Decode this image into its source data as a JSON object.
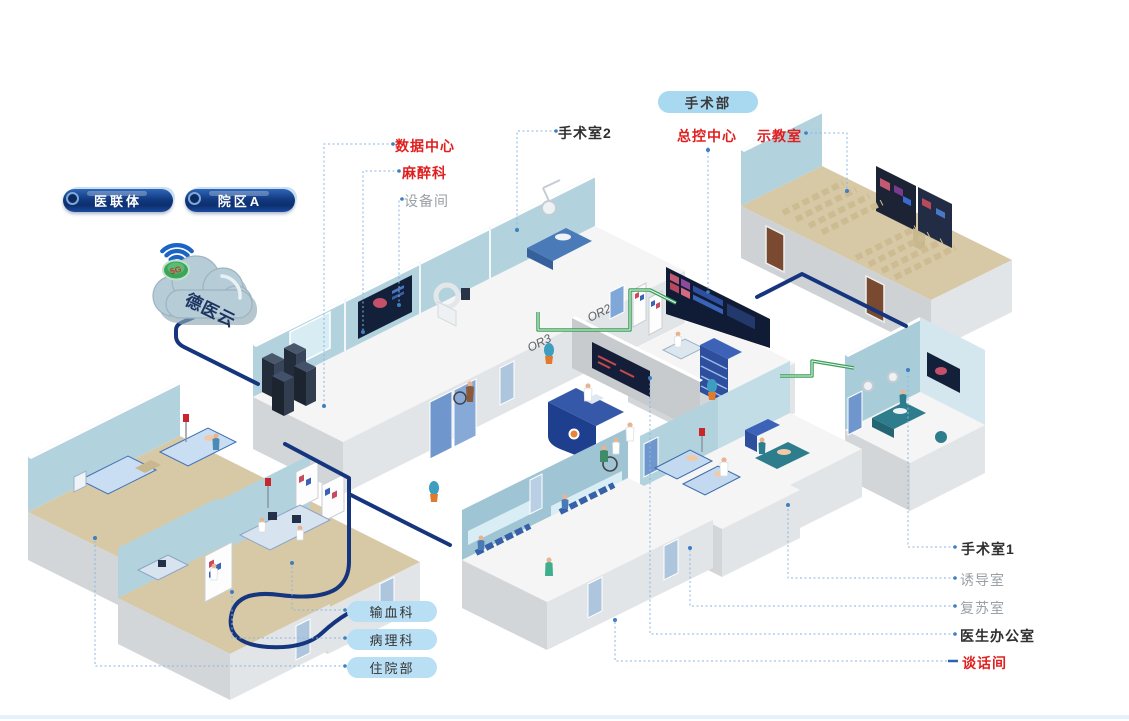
{
  "palette": {
    "accent_red": "#e01f1f",
    "label_dark": "#2f2f2f",
    "label_gray": "#9aa0a6",
    "leader_line_blue": "#8ab6e0",
    "pill_light_blue": "#a9d8f1",
    "pill_navy_top": "#2e66b8",
    "pill_navy_bottom": "#0d2f6e",
    "cable_navy": "#15357e",
    "cable_green": "#3d9e5a",
    "wall_blue": "#b2d3de",
    "floor_tan": "#d7c8a6",
    "wifi_blue": "#1b63c4"
  },
  "header": {
    "department_pill": "手术部"
  },
  "network": {
    "consortium_pill": "医联体",
    "campus_pill": "院区A",
    "cloud_label": "德医云",
    "badge_label": "5G"
  },
  "callouts": {
    "top": [
      {
        "label": "手术室2",
        "style": "dark"
      },
      {
        "label": "总控中心",
        "style": "red"
      },
      {
        "label": "示教室",
        "style": "red"
      }
    ],
    "left": [
      {
        "label": "数据中心",
        "style": "red"
      },
      {
        "label": "麻醉科",
        "style": "red"
      },
      {
        "label": "设备间",
        "style": "gray"
      }
    ],
    "right": [
      {
        "label": "手术室1",
        "style": "dark"
      },
      {
        "label": "诱导室",
        "style": "gray"
      },
      {
        "label": "复苏室",
        "style": "gray"
      },
      {
        "label": "医生办公室",
        "style": "dark"
      },
      {
        "label": "谈话间",
        "style": "red"
      }
    ],
    "bottom_pills": [
      {
        "label": "输血科"
      },
      {
        "label": "病理科"
      },
      {
        "label": "住院部"
      }
    ]
  },
  "scene": {
    "or_wall_labels": [
      "OR3",
      "OR2"
    ]
  }
}
